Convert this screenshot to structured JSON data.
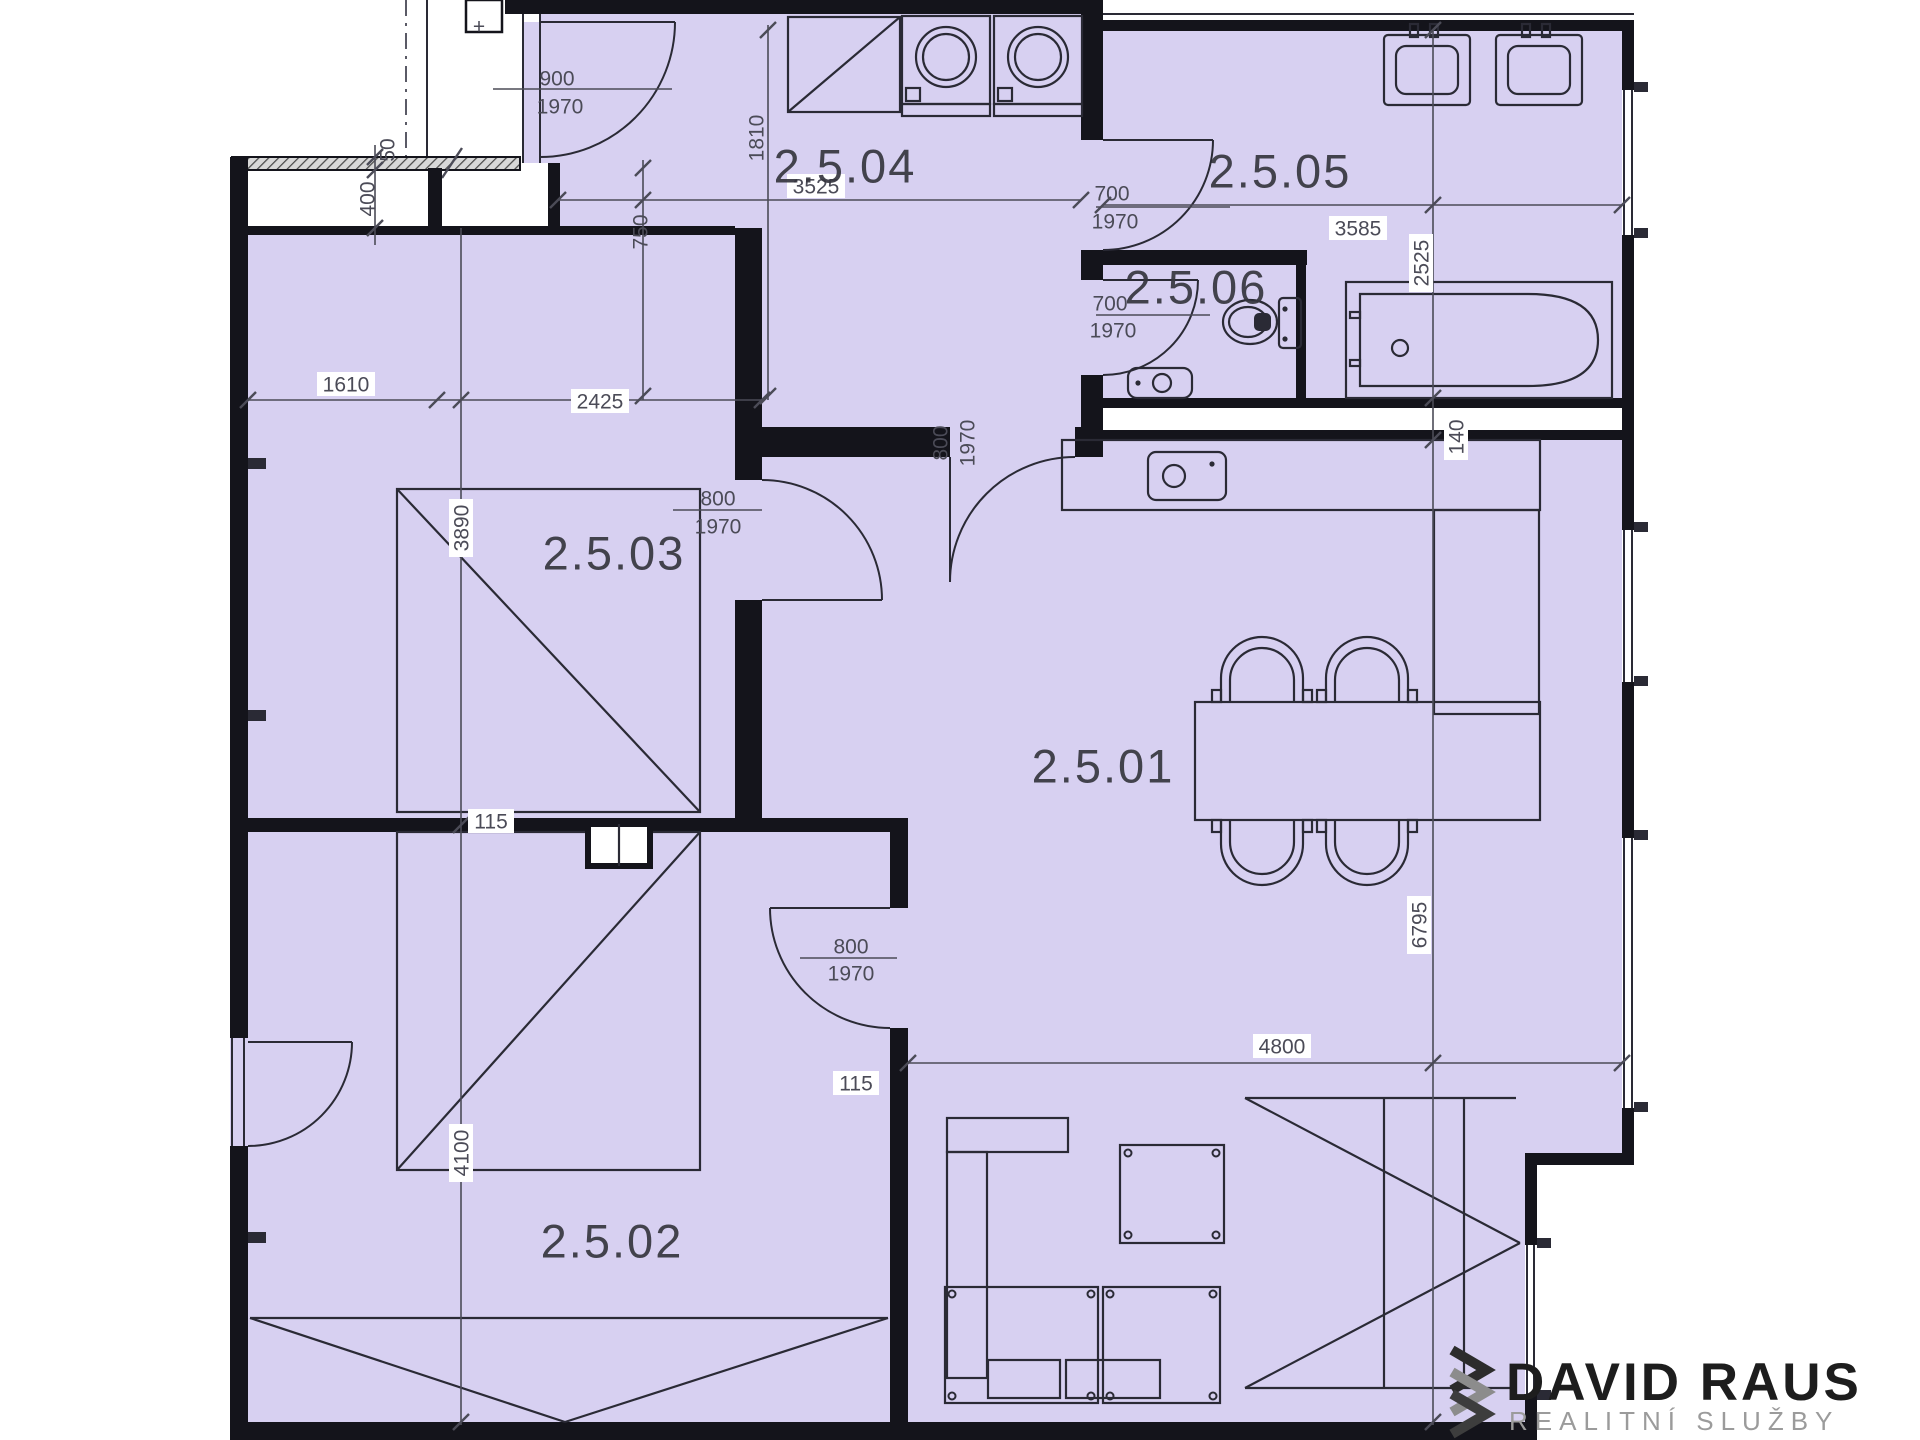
{
  "colors": {
    "room_fill": "#d7d0f1",
    "wall": "#14141b",
    "line": "#2a2a35",
    "dim": "#4b4b57",
    "room_label": "#36363f",
    "label_box": "#ffffff",
    "logo_title": "#1d1d1d",
    "logo_subtitle": "#9b9b9b",
    "chevron_1": "#2c2c2c",
    "chevron_2": "#8c8c8c",
    "chevron_3": "#3d3d3d"
  },
  "rooms": [
    {
      "label": "2.5.01",
      "x": 1103,
      "y": 765
    },
    {
      "label": "2.5.02",
      "x": 612,
      "y": 1240
    },
    {
      "label": "2.5.03",
      "x": 614,
      "y": 552
    },
    {
      "label": "2.5.04",
      "x": 845,
      "y": 165
    },
    {
      "label": "2.5.05",
      "x": 1280,
      "y": 170
    },
    {
      "label": "2.5.06",
      "x": 1196,
      "y": 286
    }
  ],
  "dims": [
    {
      "t": "900",
      "x": 557,
      "y": 78
    },
    {
      "t": "1970",
      "x": 560,
      "y": 106
    },
    {
      "t": "50",
      "x": 387,
      "y": 150,
      "r": 1
    },
    {
      "t": "400",
      "x": 367,
      "y": 199,
      "r": 1
    },
    {
      "t": "+",
      "x": 479,
      "y": 26
    },
    {
      "t": "750",
      "x": 640,
      "y": 232,
      "r": 1
    },
    {
      "t": "1810",
      "x": 756,
      "y": 138,
      "r": 1
    },
    {
      "t": "3525",
      "x": 816,
      "y": 186,
      "b": 1
    },
    {
      "t": "3585",
      "x": 1358,
      "y": 228,
      "b": 1
    },
    {
      "t": "2525",
      "x": 1421,
      "y": 263,
      "r": 1,
      "b": 1
    },
    {
      "t": "700",
      "x": 1112,
      "y": 193
    },
    {
      "t": "1970",
      "x": 1115,
      "y": 221
    },
    {
      "t": "700",
      "x": 1110,
      "y": 303
    },
    {
      "t": "1970",
      "x": 1113,
      "y": 330
    },
    {
      "t": "140",
      "x": 1456,
      "y": 437,
      "r": 1,
      "b": 1
    },
    {
      "t": "1610",
      "x": 346,
      "y": 384,
      "b": 1
    },
    {
      "t": "2425",
      "x": 600,
      "y": 401,
      "b": 1
    },
    {
      "t": "800",
      "x": 940,
      "y": 443,
      "r": 1
    },
    {
      "t": "1970",
      "x": 967,
      "y": 443,
      "r": 1
    },
    {
      "t": "3890",
      "x": 461,
      "y": 528,
      "r": 1,
      "b": 1
    },
    {
      "t": "800",
      "x": 718,
      "y": 498
    },
    {
      "t": "1970",
      "x": 718,
      "y": 526
    },
    {
      "t": "115",
      "x": 491,
      "y": 821,
      "b": 1
    },
    {
      "t": "800",
      "x": 851,
      "y": 946
    },
    {
      "t": "1970",
      "x": 851,
      "y": 973
    },
    {
      "t": "4100",
      "x": 461,
      "y": 1153,
      "r": 1,
      "b": 1
    },
    {
      "t": "4800",
      "x": 1282,
      "y": 1046,
      "b": 1
    },
    {
      "t": "115",
      "x": 856,
      "y": 1083,
      "b": 1
    },
    {
      "t": "6795",
      "x": 1419,
      "y": 925,
      "r": 1,
      "b": 1
    }
  ],
  "logo": {
    "title": "DAVID RAUS",
    "subtitle": "REALITNÍ SLUŽBY",
    "icon": "chevron-zigzag-icon"
  }
}
